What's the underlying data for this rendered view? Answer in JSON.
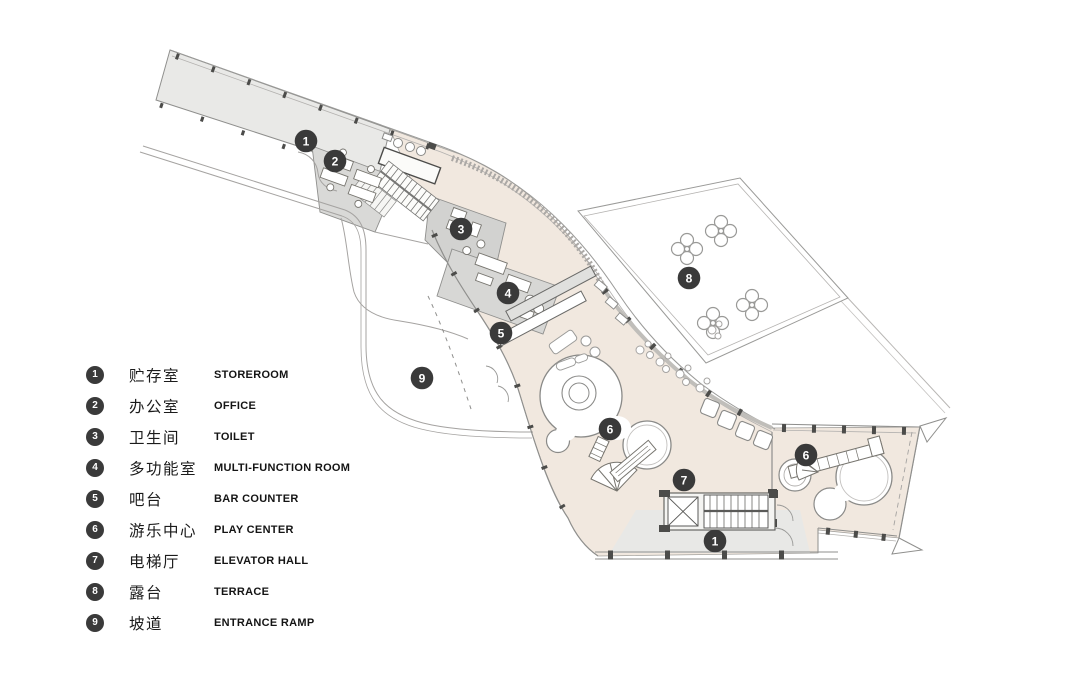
{
  "legend": {
    "items": [
      {
        "num": "1",
        "zh": "贮存室",
        "en": "STOREROOM"
      },
      {
        "num": "2",
        "zh": "办公室",
        "en": "OFFICE"
      },
      {
        "num": "3",
        "zh": "卫生间",
        "en": "TOILET"
      },
      {
        "num": "4",
        "zh": "多功能室",
        "en": "MULTI-FUNCTION ROOM"
      },
      {
        "num": "5",
        "zh": "吧台",
        "en": "BAR COUNTER"
      },
      {
        "num": "6",
        "zh": "游乐中心",
        "en": "PLAY CENTER"
      },
      {
        "num": "7",
        "zh": "电梯厅",
        "en": "ELEVATOR HALL"
      },
      {
        "num": "8",
        "zh": "露台",
        "en": "TERRACE"
      },
      {
        "num": "9",
        "zh": "坡道",
        "en": "ENTRANCE RAMP"
      }
    ]
  },
  "plan": {
    "markers": [
      {
        "num": "1",
        "x": 306,
        "y": 141,
        "room": "storeroom"
      },
      {
        "num": "2",
        "x": 335,
        "y": 161,
        "room": "office"
      },
      {
        "num": "3",
        "x": 461,
        "y": 229,
        "room": "toilet"
      },
      {
        "num": "4",
        "x": 508,
        "y": 293,
        "room": "multi-function-room"
      },
      {
        "num": "5",
        "x": 501,
        "y": 333,
        "room": "bar-counter"
      },
      {
        "num": "9",
        "x": 422,
        "y": 378,
        "room": "entrance-ramp"
      },
      {
        "num": "6",
        "x": 610,
        "y": 429,
        "room": "play-center"
      },
      {
        "num": "7",
        "x": 684,
        "y": 480,
        "room": "elevator-hall"
      },
      {
        "num": "1",
        "x": 715,
        "y": 541,
        "room": "storeroom"
      },
      {
        "num": "6",
        "x": 806,
        "y": 455,
        "room": "play-center"
      },
      {
        "num": "8",
        "x": 689,
        "y": 278,
        "room": "terrace"
      }
    ],
    "colors": {
      "marker": "#3a3a3a",
      "hall": "#f1e8df",
      "wing": "#e9e9e7",
      "office": "#d9d9d7",
      "toilet": "#d2d2d0",
      "mfr": "#d7d7d5",
      "service": "#e8e8e6",
      "line": "#8f8f8d",
      "wall_dark": "#4c4c4a",
      "soft_line": "#b0aeac"
    }
  }
}
